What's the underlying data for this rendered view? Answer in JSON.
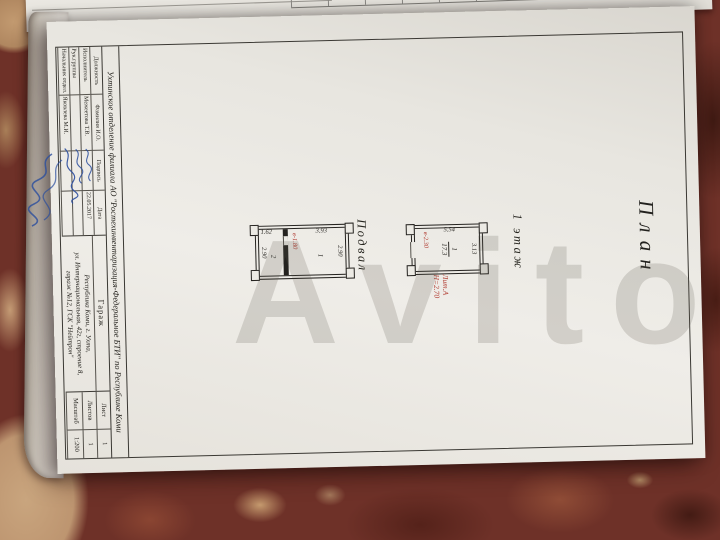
{
  "watermark": "Avito",
  "under_sheet": {
    "cells": [
      "",
      "",
      "",
      "80",
      "7",
      "0",
      "7",
      "",
      "",
      "7",
      ""
    ]
  },
  "doc": {
    "title": "План",
    "header": "Ухтинское отделение филиала АО \"Ростехинвентаризация-Федеральное БТИ\" по Республике Коми",
    "floor1": {
      "label": "1 этаж",
      "dim_depth": "5.54",
      "dim_width": "3.13",
      "height_red": "в-2.30",
      "room_number": "1",
      "room_area": "17.3",
      "liter": "Лит.А",
      "building_height": "Н=2.70"
    },
    "basement": {
      "label": "Подвал",
      "dim_width_top": "2.90",
      "dim_width_bottom": "2.90",
      "dim_room1": "3.93",
      "dim_room2": "1.62",
      "height_red": "в-1.80",
      "room1_number": "1",
      "room2_number": "2"
    },
    "stamp": {
      "object": "Гараж",
      "address_line1": "Республика Коми, г. Ухта,",
      "address_line2": "ул. Интернациональная, 42г, строение 8,",
      "address_line3": "гараж №12, ГСК \"Нейтрон\"",
      "sig_table": {
        "col_role": "Должность",
        "col_name": "Фамилия И.О.",
        "col_sign": "Подпись",
        "col_date": "Дата",
        "rows": [
          {
            "role": "Исполнитель",
            "name": "Межеетова Т.В.",
            "date": "22.05.2017"
          },
          {
            "role": "Рук.группы",
            "name": "",
            "date": ""
          },
          {
            "role": "Начальник отдел.",
            "name": "Яковлева М.И.",
            "date": ""
          }
        ]
      },
      "sheet_table": {
        "rows": [
          {
            "label": "Лист",
            "value": "1"
          },
          {
            "label": "Листов",
            "value": "1"
          },
          {
            "label": "Масштаб",
            "value": "1:200"
          }
        ]
      }
    }
  }
}
